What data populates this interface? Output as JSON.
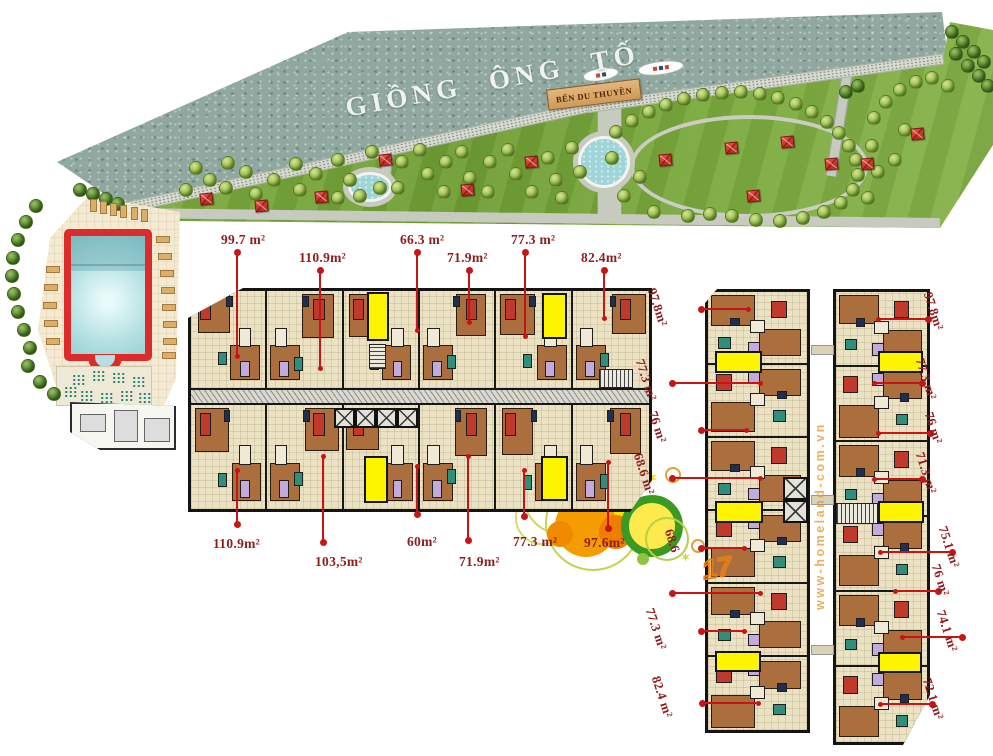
{
  "banner": {
    "river_name": "GIỒNG ÔNG TỐ",
    "marina_sign": "BẾN DU THUYỀN"
  },
  "watermark_text": "www-homeland-com.vn",
  "sketch_number": "17",
  "decor_star": "✶",
  "colors": {
    "leader_red": "#c81414",
    "label_red": "#8e1d1d",
    "highlight_yellow": "#fdf500",
    "lawn_green": "#76a73a",
    "water_grey": "#91a8a1",
    "pool_red": "#dc2b2b",
    "room_brown": "#aa6f3d",
    "floor_cream": "#ebe2c3"
  },
  "area_labels": {
    "central_top": [
      {
        "text": "99.7 m²",
        "tx": 221,
        "ty": 232,
        "lx": 236,
        "y1": 252,
        "y2": 356
      },
      {
        "text": "110.9m²",
        "tx": 299,
        "ty": 250,
        "lx": 319,
        "y1": 270,
        "y2": 368
      },
      {
        "text": "66.3 m²",
        "tx": 400,
        "ty": 232,
        "lx": 416,
        "y1": 252,
        "y2": 330
      },
      {
        "text": "71.9m²",
        "tx": 447,
        "ty": 250,
        "lx": 468,
        "y1": 270,
        "y2": 322
      },
      {
        "text": "77.3 m²",
        "tx": 511,
        "ty": 232,
        "lx": 524,
        "y1": 252,
        "y2": 336
      },
      {
        "text": "82.4m²",
        "tx": 581,
        "ty": 250,
        "lx": 603,
        "y1": 270,
        "y2": 318
      }
    ],
    "central_bottom": [
      {
        "text": "110.9m²",
        "tx": 213,
        "ty": 536,
        "lx": 236,
        "y1": 470,
        "y2": 524
      },
      {
        "text": "103,5m²",
        "tx": 315,
        "ty": 554,
        "lx": 322,
        "y1": 456,
        "y2": 542
      },
      {
        "text": "60m²",
        "tx": 407,
        "ty": 534,
        "lx": 416,
        "y1": 466,
        "y2": 514
      },
      {
        "text": "71.9m²",
        "tx": 459,
        "ty": 554,
        "lx": 467,
        "y1": 456,
        "y2": 540
      },
      {
        "text": "77.3 m²",
        "tx": 513,
        "ty": 534,
        "lx": 523,
        "y1": 470,
        "y2": 516
      },
      {
        "text": "97.6m²",
        "tx": 584,
        "ty": 535,
        "lx": 607,
        "y1": 462,
        "y2": 528
      }
    ],
    "tower_left": [
      {
        "text": "97.8m²",
        "tx": 659,
        "ty": 286,
        "x1": 701,
        "x2": 748,
        "ly": 308
      },
      {
        "text": "77.3 m²",
        "tx": 647,
        "ty": 357,
        "x1": 672,
        "x2": 760,
        "ly": 382
      },
      {
        "text": "76 m²",
        "tx": 660,
        "ty": 409,
        "x1": 701,
        "x2": 746,
        "ly": 429
      },
      {
        "text": "68.6 m²",
        "tx": 645,
        "ty": 451,
        "x1": 672,
        "x2": 760,
        "ly": 477
      },
      {
        "text": "68.6",
        "tx": 676,
        "ty": 527,
        "x1": 701,
        "x2": 744,
        "ly": 547
      },
      {
        "text": "",
        "tx": 0,
        "ty": 0,
        "x1": 672,
        "x2": 760,
        "ly": 592
      },
      {
        "text": "77.3 m²",
        "tx": 657,
        "ty": 606,
        "x1": 701,
        "x2": 744,
        "ly": 630
      },
      {
        "text": "82.4 m²",
        "tx": 663,
        "ty": 674,
        "x1": 702,
        "x2": 758,
        "ly": 702
      }
    ],
    "tower_right": [
      {
        "text": "97.8m²",
        "tx": 935,
        "ty": 290,
        "x1": 878,
        "x2": 928,
        "ly": 318
      },
      {
        "text": "77.3 m²",
        "tx": 927,
        "ty": 356,
        "x1": 874,
        "x2": 922,
        "ly": 382
      },
      {
        "text": "76 m²",
        "tx": 936,
        "ty": 410,
        "x1": 878,
        "x2": 930,
        "ly": 432
      },
      {
        "text": "71.3 m²",
        "tx": 927,
        "ty": 450,
        "x1": 874,
        "x2": 922,
        "ly": 478
      },
      {
        "text": "75.1 m²",
        "tx": 950,
        "ty": 524,
        "x1": 880,
        "x2": 952,
        "ly": 551
      },
      {
        "text": "76 m²",
        "tx": 943,
        "ty": 562,
        "x1": 895,
        "x2": 938,
        "ly": 590
      },
      {
        "text": "74.1 m²",
        "tx": 948,
        "ty": 608,
        "x1": 902,
        "x2": 962,
        "ly": 636
      },
      {
        "text": "72.1 m²",
        "tx": 934,
        "ty": 676,
        "x1": 880,
        "x2": 932,
        "ly": 703
      }
    ]
  },
  "floorplans": {
    "central_units": 6,
    "tower_units": 6,
    "highlight_units": [
      [
        367,
        292,
        22,
        49
      ],
      [
        542,
        293,
        25,
        46
      ],
      [
        364,
        456,
        24,
        47
      ],
      [
        541,
        456,
        27,
        45
      ],
      [
        715,
        351,
        47,
        22
      ],
      [
        715,
        501,
        48,
        22
      ],
      [
        715,
        651,
        46,
        21
      ],
      [
        878,
        351,
        45,
        22
      ],
      [
        878,
        501,
        46,
        22
      ],
      [
        878,
        652,
        44,
        21
      ]
    ],
    "elevators": [
      {
        "x": 334,
        "y": 408,
        "n": 4,
        "cw": 21,
        "ch": 20,
        "dir": "h"
      },
      {
        "x": 783,
        "y": 477,
        "n": 2,
        "cw": 25,
        "ch": 23,
        "dir": "v"
      }
    ],
    "stairs": [
      {
        "x": 369,
        "y": 344,
        "w": 17,
        "h": 25,
        "dir": "h"
      },
      {
        "x": 599,
        "y": 369,
        "w": 34,
        "h": 19,
        "dir": "v"
      },
      {
        "x": 836,
        "y": 503,
        "w": 42,
        "h": 21,
        "dir": "v"
      }
    ],
    "bridges": [
      [
        811,
        345
      ],
      [
        811,
        495
      ],
      [
        811,
        645
      ]
    ]
  },
  "park": {
    "trees": [
      [
        196,
        168
      ],
      [
        186,
        190
      ],
      [
        210,
        180
      ],
      [
        228,
        163
      ],
      [
        226,
        188
      ],
      [
        246,
        172
      ],
      [
        256,
        194
      ],
      [
        274,
        180
      ],
      [
        296,
        164
      ],
      [
        300,
        190
      ],
      [
        316,
        174
      ],
      [
        338,
        160
      ],
      [
        350,
        180
      ],
      [
        360,
        196
      ],
      [
        338,
        198
      ],
      [
        372,
        152
      ],
      [
        380,
        188
      ],
      [
        402,
        162
      ],
      [
        398,
        188
      ],
      [
        420,
        150
      ],
      [
        428,
        174
      ],
      [
        446,
        162
      ],
      [
        444,
        192
      ],
      [
        462,
        152
      ],
      [
        470,
        178
      ],
      [
        490,
        162
      ],
      [
        488,
        192
      ],
      [
        508,
        150
      ],
      [
        516,
        174
      ],
      [
        532,
        192
      ],
      [
        548,
        158
      ],
      [
        556,
        180
      ],
      [
        572,
        148
      ],
      [
        580,
        172
      ],
      [
        562,
        198
      ],
      [
        616,
        132
      ],
      [
        632,
        121
      ],
      [
        649,
        112
      ],
      [
        666,
        105
      ],
      [
        684,
        99
      ],
      [
        703,
        95
      ],
      [
        722,
        93
      ],
      [
        741,
        92
      ],
      [
        760,
        94
      ],
      [
        778,
        98
      ],
      [
        796,
        104
      ],
      [
        812,
        112
      ],
      [
        827,
        122
      ],
      [
        839,
        133
      ],
      [
        849,
        146
      ],
      [
        856,
        160
      ],
      [
        858,
        175
      ],
      [
        853,
        190
      ],
      [
        841,
        203
      ],
      [
        824,
        212
      ],
      [
        803,
        218
      ],
      [
        780,
        221
      ],
      [
        756,
        220
      ],
      [
        732,
        216
      ],
      [
        640,
        177
      ],
      [
        624,
        196
      ],
      [
        654,
        212
      ],
      [
        688,
        216
      ],
      [
        612,
        158
      ],
      [
        710,
        214
      ],
      [
        874,
        118
      ],
      [
        886,
        102
      ],
      [
        900,
        90
      ],
      [
        916,
        82
      ],
      [
        932,
        78
      ],
      [
        948,
        86
      ],
      [
        872,
        146
      ],
      [
        878,
        172
      ],
      [
        868,
        198
      ],
      [
        895,
        160
      ],
      [
        905,
        130
      ]
    ],
    "dark_trees": [
      [
        846,
        92
      ],
      [
        858,
        86
      ],
      [
        952,
        32
      ],
      [
        963,
        42
      ],
      [
        974,
        52
      ],
      [
        984,
        62
      ],
      [
        956,
        54
      ],
      [
        968,
        66
      ],
      [
        979,
        76
      ],
      [
        988,
        86
      ],
      [
        80,
        190
      ],
      [
        93,
        194
      ],
      [
        106,
        199
      ],
      [
        118,
        204
      ],
      [
        36,
        206
      ],
      [
        26,
        222
      ],
      [
        18,
        240
      ],
      [
        13,
        258
      ],
      [
        12,
        276
      ],
      [
        14,
        294
      ],
      [
        18,
        312
      ],
      [
        24,
        330
      ],
      [
        30,
        348
      ],
      [
        28,
        366
      ],
      [
        40,
        382
      ],
      [
        54,
        394
      ]
    ],
    "pavilions": [
      [
        207,
        199
      ],
      [
        262,
        206
      ],
      [
        322,
        197
      ],
      [
        386,
        160
      ],
      [
        468,
        190
      ],
      [
        532,
        162
      ],
      [
        666,
        160
      ],
      [
        732,
        148
      ],
      [
        788,
        142
      ],
      [
        832,
        164
      ],
      [
        754,
        196
      ],
      [
        868,
        164
      ],
      [
        918,
        134
      ]
    ]
  },
  "pool": {
    "chairs_top": [
      [
        90,
        199
      ],
      [
        100,
        201
      ],
      [
        110,
        203
      ],
      [
        120,
        205
      ],
      [
        131,
        207
      ],
      [
        141,
        209
      ]
    ],
    "chairs_side": [
      [
        156,
        236
      ],
      [
        158,
        253
      ],
      [
        160,
        270
      ],
      [
        161,
        287
      ],
      [
        162,
        304
      ],
      [
        163,
        321
      ],
      [
        163,
        338
      ],
      [
        162,
        352
      ],
      [
        46,
        266
      ],
      [
        44,
        284
      ],
      [
        43,
        302
      ],
      [
        44,
        320
      ],
      [
        46,
        338
      ]
    ],
    "plaza_tables": [
      [
        72,
        374
      ],
      [
        92,
        370
      ],
      [
        112,
        372
      ],
      [
        132,
        376
      ],
      [
        80,
        390
      ],
      [
        100,
        392
      ],
      [
        120,
        390
      ],
      [
        64,
        386
      ],
      [
        138,
        392
      ]
    ]
  }
}
